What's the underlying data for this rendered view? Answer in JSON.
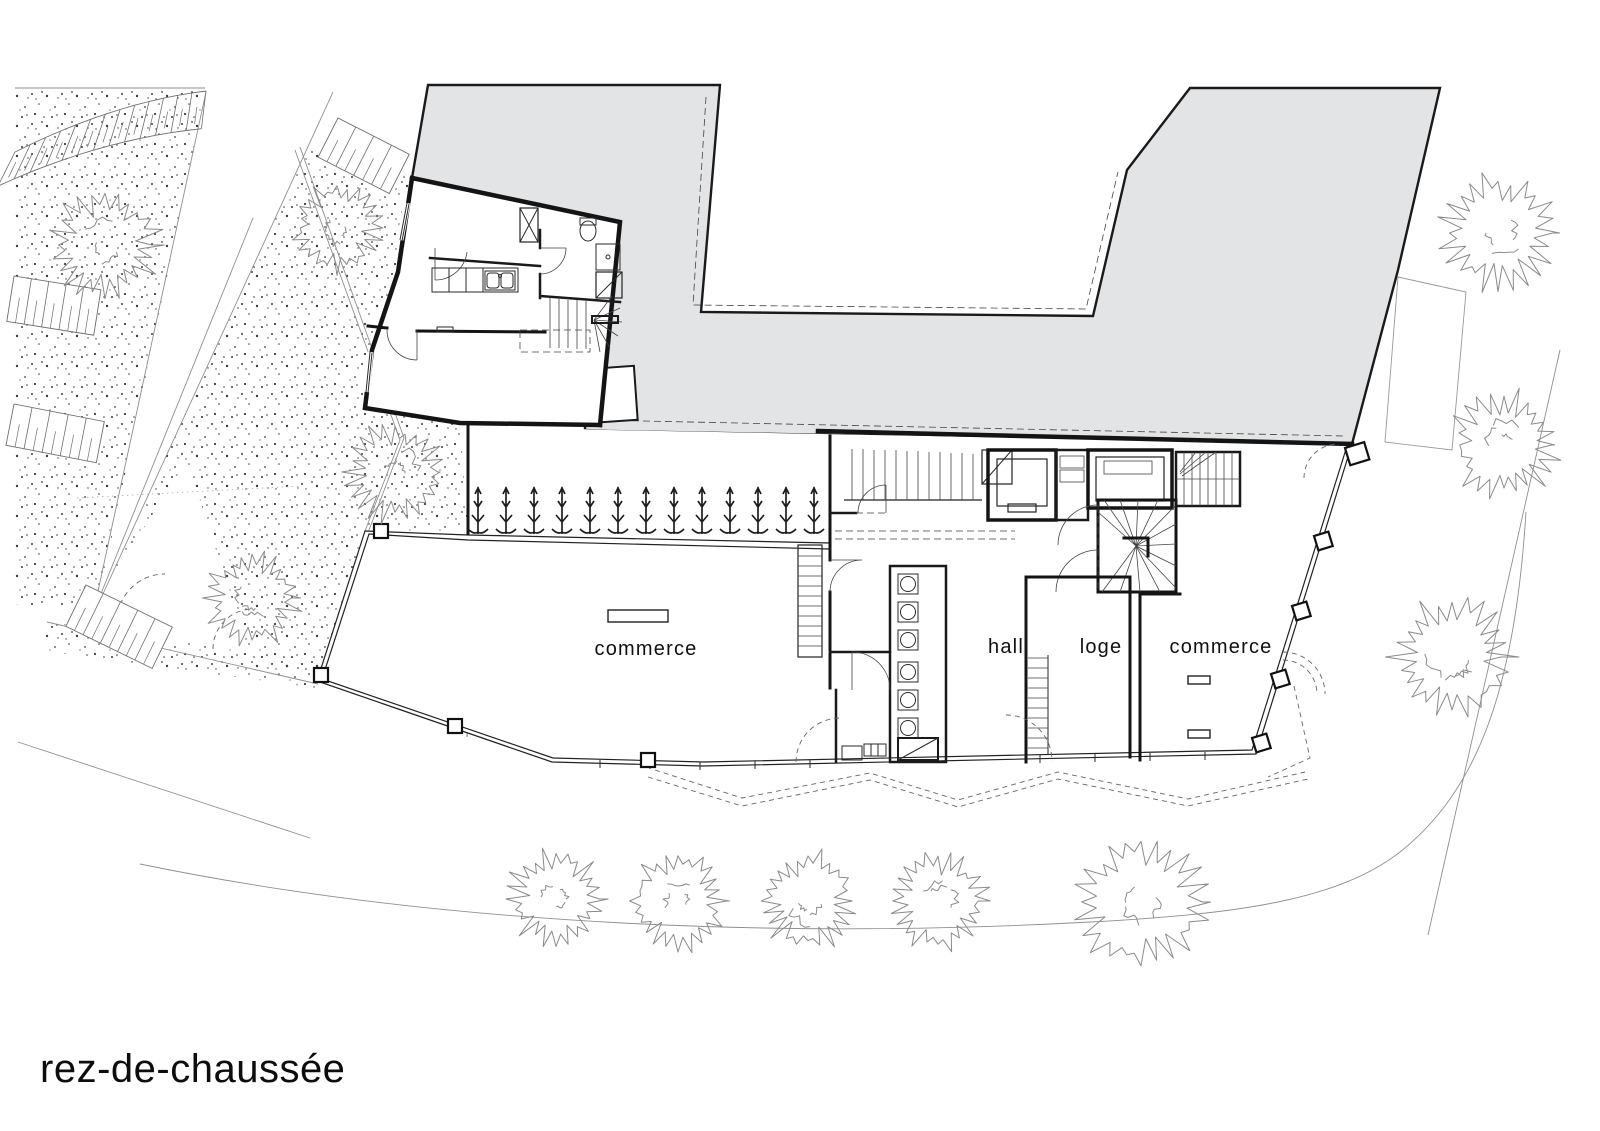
{
  "drawing": {
    "title": "rez-de-chaussée"
  },
  "rooms": [
    {
      "id": "commerce-left",
      "label": "commerce"
    },
    {
      "id": "hall",
      "label": "hall"
    },
    {
      "id": "loge",
      "label": "loge"
    },
    {
      "id": "commerce-right",
      "label": "commerce"
    }
  ],
  "colors": {
    "existing_mass": "#e3e4e6",
    "mass_outline": "#1a1a1a",
    "wall": "#141414",
    "site_line": "#8f8f8f",
    "tree_stroke": "#8a8a8a",
    "stipple_dot": "#3c3c3c"
  },
  "site": {
    "trees": [
      {
        "x": 105,
        "y": 245,
        "r": 56
      },
      {
        "x": 337,
        "y": 228,
        "r": 46
      },
      {
        "x": 395,
        "y": 472,
        "r": 50
      },
      {
        "x": 252,
        "y": 598,
        "r": 48
      },
      {
        "x": 556,
        "y": 899,
        "r": 50
      },
      {
        "x": 678,
        "y": 901,
        "r": 50
      },
      {
        "x": 808,
        "y": 901,
        "r": 50
      },
      {
        "x": 938,
        "y": 901,
        "r": 50
      },
      {
        "x": 1141,
        "y": 902,
        "r": 68
      },
      {
        "x": 1498,
        "y": 233,
        "r": 58
      },
      {
        "x": 1504,
        "y": 445,
        "r": 55
      },
      {
        "x": 1452,
        "y": 657,
        "r": 62
      }
    ],
    "plant_row": {
      "count": 13,
      "x_start": 478,
      "x_end": 814,
      "baseline_y": 531
    },
    "parking_bands": [
      {
        "type": "curve",
        "p0": [
          15,
          152
        ],
        "c": [
          115,
          102
        ],
        "p1": [
          206,
          91
        ],
        "width": 38,
        "slots": 13
      },
      {
        "type": "rect",
        "x": 14,
        "y": 276,
        "w": 88,
        "h": 46,
        "angle": 9,
        "slots": 5
      },
      {
        "type": "rect",
        "x": 14,
        "y": 404,
        "w": 92,
        "h": 42,
        "angle": 11,
        "slots": 5
      },
      {
        "type": "rect",
        "x": 86,
        "y": 585,
        "w": 96,
        "h": 46,
        "angle": 26,
        "slots": 5
      },
      {
        "type": "rect",
        "x": 338,
        "y": 118,
        "w": 80,
        "h": 44,
        "angle": 27,
        "slots": 4
      }
    ]
  }
}
